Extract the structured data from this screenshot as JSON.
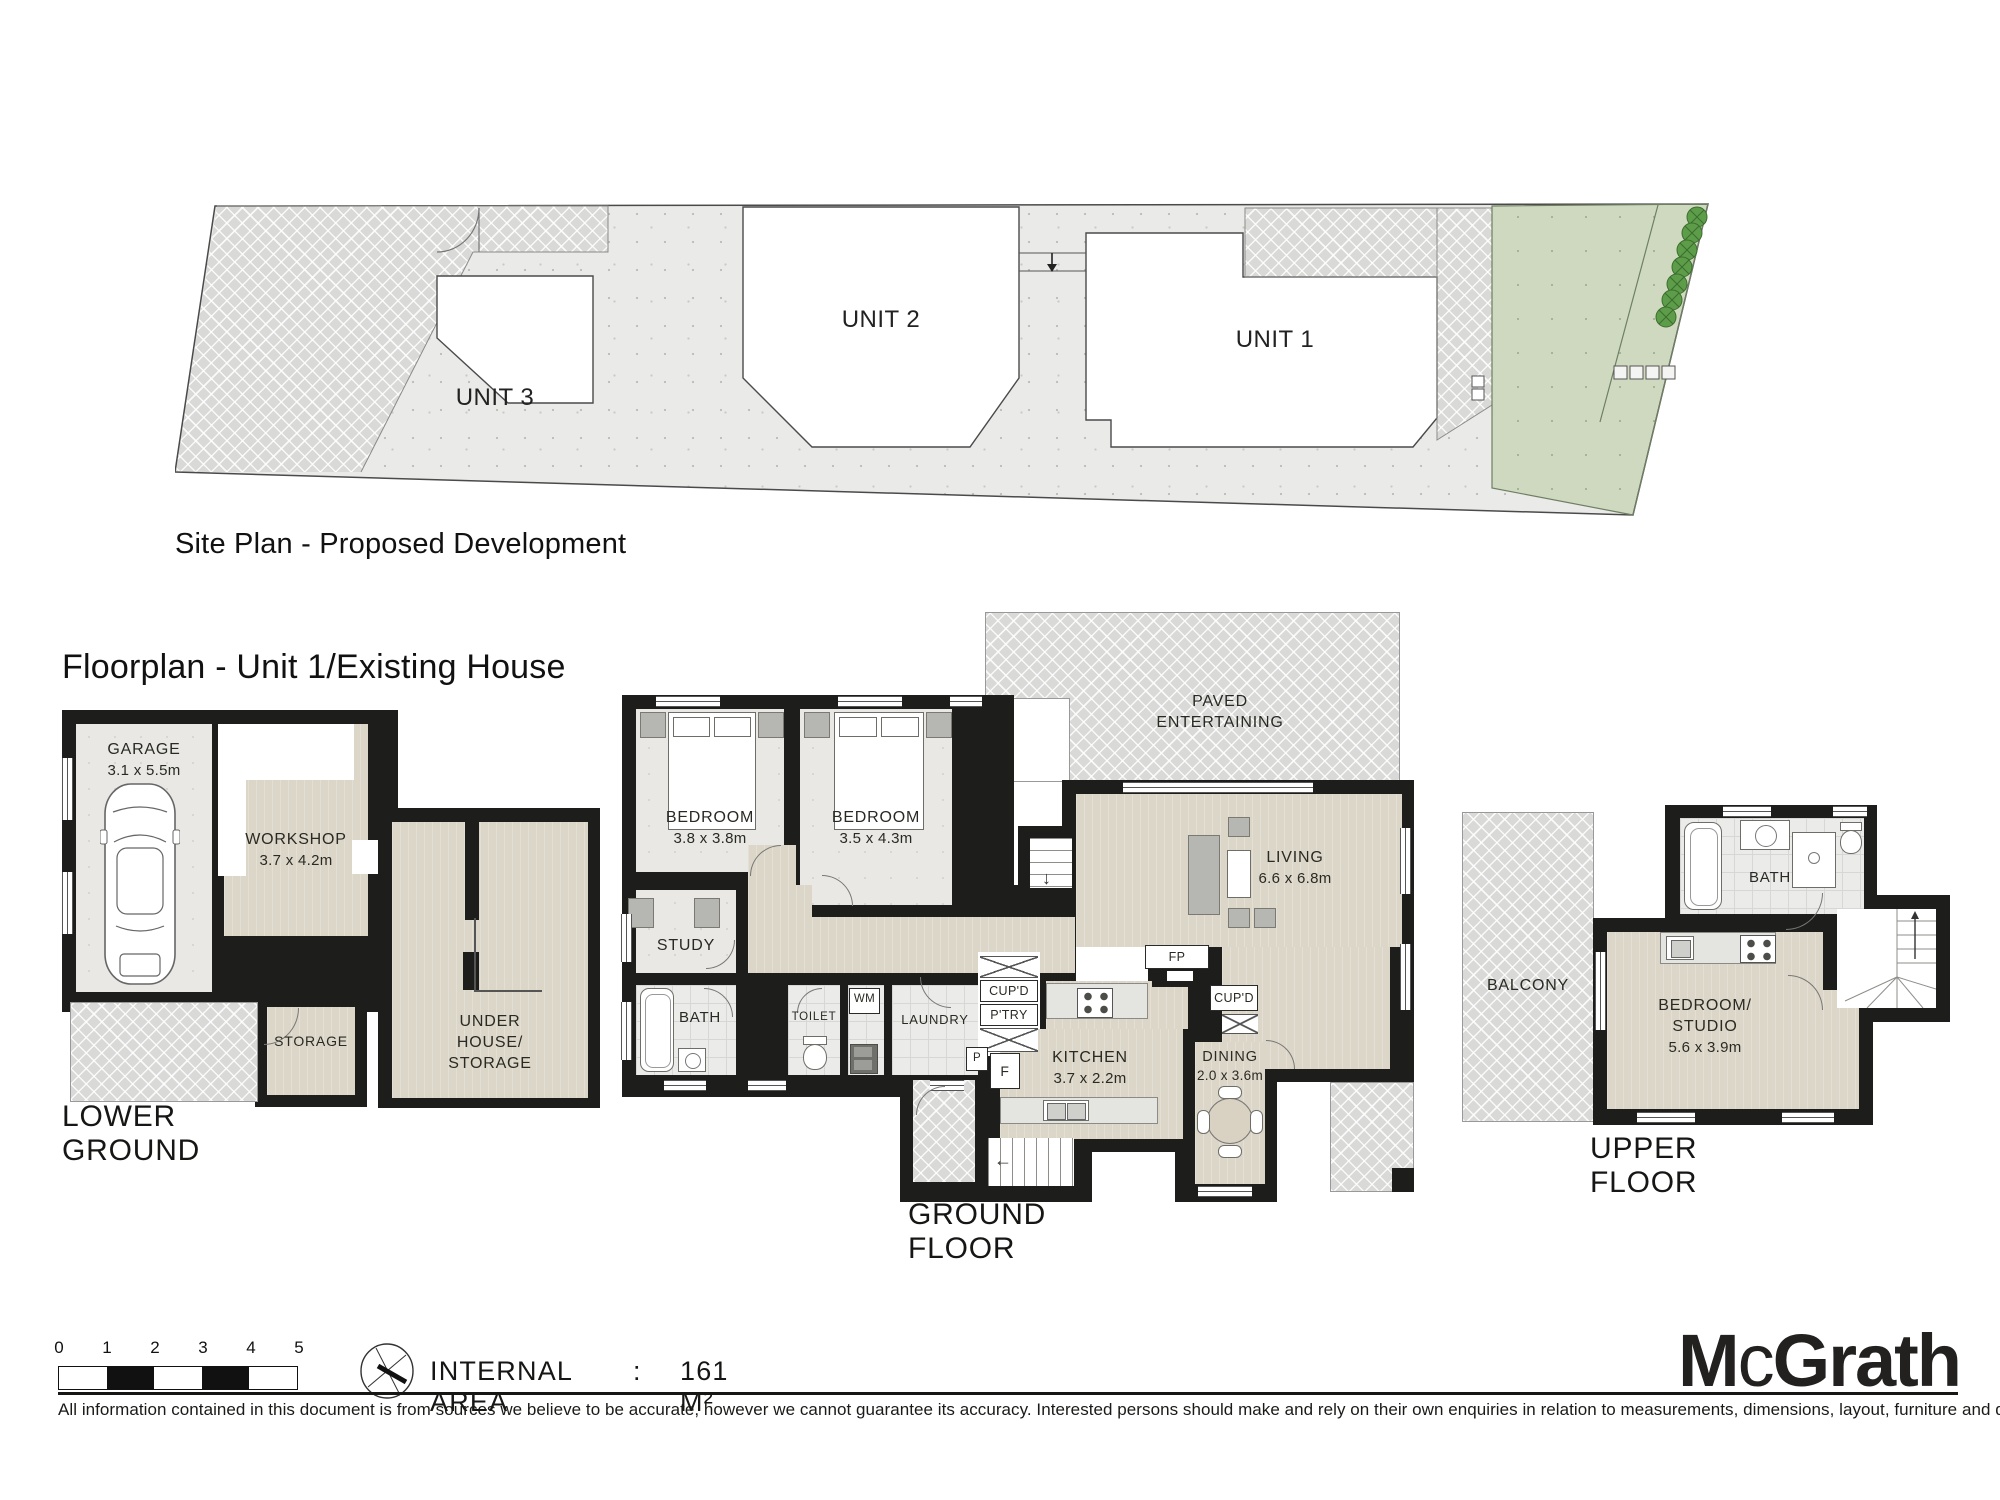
{
  "page": {
    "site_plan_caption": "Site Plan - Proposed Development",
    "floorplan_heading": "Floorplan - Unit 1/Existing House"
  },
  "site_plan": {
    "unit1": "UNIT 1",
    "unit2": "UNIT 2",
    "unit3": "UNIT 3"
  },
  "lower_ground": {
    "title": "LOWER GROUND",
    "garage_name": "GARAGE",
    "garage_dims": "3.1 x 5.5m",
    "workshop_name": "WORKSHOP",
    "workshop_dims": "3.7 x 4.2m",
    "storage_name": "STORAGE",
    "under_house_l1": "UNDER",
    "under_house_l2": "HOUSE/",
    "under_house_l3": "STORAGE"
  },
  "ground_floor": {
    "title": "GROUND FLOOR",
    "paved_l1": "PAVED",
    "paved_l2": "ENTERTAINING",
    "bedroom1_name": "BEDROOM",
    "bedroom1_dims": "3.8 x 3.8m",
    "bedroom2_name": "BEDROOM",
    "bedroom2_dims": "3.5 x 4.3m",
    "study_name": "STUDY",
    "bath_name": "BATH",
    "toilet_name": "TOILET",
    "wm_name": "WM",
    "laundry_name": "LAUNDRY",
    "cupd_left": "CUP'D",
    "ptry": "P'TRY",
    "p": "P",
    "f": "F",
    "fp": "FP",
    "cupd_right": "CUP'D",
    "kitchen_name": "KITCHEN",
    "kitchen_dims": "3.7 x 2.2m",
    "dining_name": "DINING",
    "dining_dims": "2.0 x 3.6m",
    "living_name": "LIVING",
    "living_dims": "6.6 x 6.8m"
  },
  "upper_floor": {
    "title": "UPPER FLOOR",
    "balcony_name": "BALCONY",
    "bath_name": "BATH",
    "bedroom_studio_l1": "BEDROOM/",
    "bedroom_studio_l2": "STUDIO",
    "bedroom_studio_dims": "5.6 x 3.9m"
  },
  "footer": {
    "scale_ticks": [
      "0",
      "1",
      "2",
      "3",
      "4",
      "5"
    ],
    "internal_area_label": "INTERNAL AREA",
    "separator": ":",
    "internal_area_value": "161 M²",
    "brand_m": "M",
    "brand_c": "c",
    "brand_rest": "Grath",
    "disclaimer": "All information contained in this document is from sources we believe to be accurate, however we cannot guarantee its accuracy. Interested persons should make and rely on their own enquiries in relation to measurements, dimensions, layout, furniture and description."
  },
  "colors": {
    "wall": "#1d1d1b",
    "floor_beige": "#dcd6c8",
    "floor_gray": "#e9e8e4",
    "paving": "#d9d9d7",
    "lawn": "#cfd9c0",
    "tree": "#5d9c49"
  }
}
